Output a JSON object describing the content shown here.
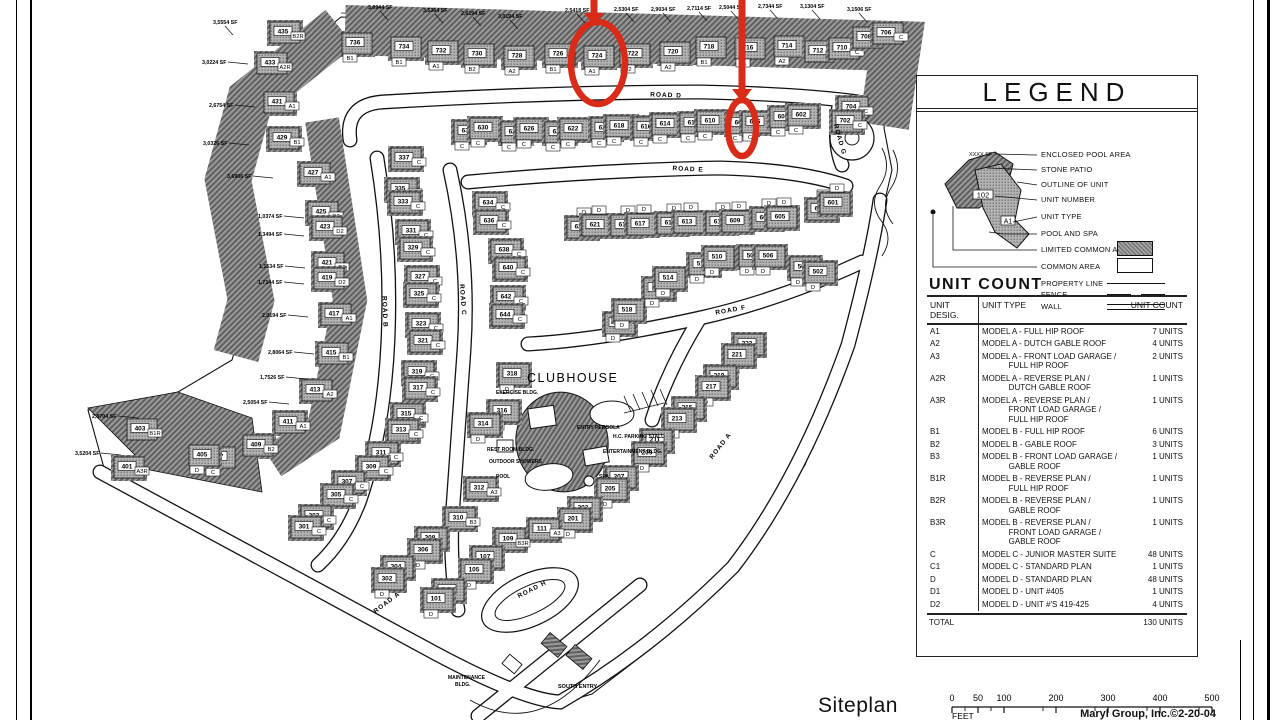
{
  "page": {
    "title_text": "Siteplan",
    "credit": "Maryl Group, Inc.©2-20-04",
    "feet_label": "FEET"
  },
  "legend": {
    "title": "LEGEND",
    "sample": {
      "sf": "XXXX SF",
      "number": "102",
      "type": "A1"
    },
    "items": [
      {
        "label": "ENCLOSED POOL AREA"
      },
      {
        "label": "STONE PATIO"
      },
      {
        "label": "OUTLINE OF UNIT"
      },
      {
        "label": "UNIT NUMBER"
      },
      {
        "label": "UNIT TYPE"
      },
      {
        "label": "POOL AND SPA"
      },
      {
        "label": "LIMITED COMMON AREA",
        "swatch": "hatched"
      },
      {
        "label": "COMMON AREA",
        "swatch": "open"
      },
      {
        "label": "PROPERTY LINE",
        "swatch": "line-solid"
      },
      {
        "label": "FENCE",
        "swatch": "line-dash"
      },
      {
        "label": "WALL",
        "swatch": "line-double"
      }
    ]
  },
  "unit_count": {
    "title": "UNIT COUNT",
    "col_desig_line1": "UNIT",
    "col_desig_line2": "DESIG.",
    "col_type": "UNIT TYPE",
    "col_count": "UNIT COUNT",
    "rows": [
      {
        "desig": "A1",
        "type": [
          "MODEL A - FULL HIP ROOF"
        ],
        "count": "7 UNITS"
      },
      {
        "desig": "A2",
        "type": [
          "MODEL A - DUTCH GABLE ROOF"
        ],
        "count": "4 UNITS"
      },
      {
        "desig": "A3",
        "type": [
          "MODEL A - FRONT LOAD GARAGE /",
          "FULL HIP ROOF"
        ],
        "count": "2 UNITS"
      },
      {
        "desig": "A2R",
        "type": [
          "MODEL A - REVERSE PLAN /",
          "DUTCH GABLE ROOF"
        ],
        "count": "1 UNITS"
      },
      {
        "desig": "A3R",
        "type": [
          "MODEL A - REVERSE PLAN /",
          "FRONT LOAD GARAGE /",
          "FULL HIP ROOF"
        ],
        "count": "1 UNITS"
      },
      {
        "desig": "B1",
        "type": [
          "MODEL B - FULL HIP ROOF"
        ],
        "count": "6 UNITS"
      },
      {
        "desig": "B2",
        "type": [
          "MODEL B - GABLE ROOF"
        ],
        "count": "3 UNITS"
      },
      {
        "desig": "B3",
        "type": [
          "MODEL B - FRONT LOAD GARAGE /",
          "GABLE ROOF"
        ],
        "count": "1 UNITS"
      },
      {
        "desig": "B1R",
        "type": [
          "MODEL B - REVERSE PLAN /",
          "FULL HIP ROOF"
        ],
        "count": "1 UNITS"
      },
      {
        "desig": "B2R",
        "type": [
          "MODEL B - REVERSE PLAN /",
          "GABLE ROOF"
        ],
        "count": "1 UNITS"
      },
      {
        "desig": "B3R",
        "type": [
          "MODEL B - REVERSE PLAN /",
          "FRONT LOAD GARAGE /",
          "GABLE ROOF"
        ],
        "count": "1 UNITS"
      },
      {
        "desig": "C",
        "type": [
          "MODEL C - JUNIOR MASTER SUITE"
        ],
        "count": "48 UNITS"
      },
      {
        "desig": "C1",
        "type": [
          "MODEL C - STANDARD PLAN"
        ],
        "count": "1 UNITS"
      },
      {
        "desig": "D",
        "type": [
          "MODEL D - STANDARD PLAN"
        ],
        "count": "48 UNITS"
      },
      {
        "desig": "D1",
        "type": [
          "MODEL D - UNIT #405"
        ],
        "count": "1 UNITS"
      },
      {
        "desig": "D2",
        "type": [
          "MODEL D - UNIT #'S 419-425"
        ],
        "count": "4 UNITS"
      }
    ],
    "total_label": "TOTAL",
    "total_count": "130 UNITS"
  },
  "scale_bar": {
    "ticks": [
      0,
      50,
      100,
      200,
      300,
      400,
      500
    ]
  },
  "map": {
    "road_labels": [
      {
        "t": "ROAD A",
        "x": 722,
        "y": 447,
        "r": -52
      },
      {
        "t": "ROAD A",
        "x": 388,
        "y": 604,
        "r": -37
      },
      {
        "t": "ROAD B",
        "x": 383,
        "y": 312,
        "r": 88
      },
      {
        "t": "ROAD C",
        "x": 461,
        "y": 300,
        "r": 86
      },
      {
        "t": "ROAD D",
        "x": 666,
        "y": 97,
        "r": 2
      },
      {
        "t": "ROAD E",
        "x": 688,
        "y": 171,
        "r": 3
      },
      {
        "t": "ROAD F",
        "x": 731,
        "y": 312,
        "r": -10
      },
      {
        "t": "ROAD G",
        "x": 838,
        "y": 140,
        "r": 74
      },
      {
        "t": "ROAD H",
        "x": 533,
        "y": 591,
        "r": -27
      }
    ],
    "site_labels": [
      {
        "t": "CLUBHOUSE",
        "x": 527,
        "y": 382,
        "s": 12.5
      },
      {
        "t": "EXERCISE BLDG.",
        "x": 496,
        "y": 394,
        "s": 5
      },
      {
        "t": "ENTRY PERGOLA",
        "x": 577,
        "y": 429,
        "s": 5
      },
      {
        "t": "H.C. PARKING STALL",
        "x": 613,
        "y": 438,
        "s": 5
      },
      {
        "t": "ENTERTAINMENT BLDG.",
        "x": 603,
        "y": 453,
        "s": 5
      },
      {
        "t": "REST ROOM BLDG.",
        "x": 487,
        "y": 451,
        "s": 5
      },
      {
        "t": "OUTDOOR SHOWERS",
        "x": 489,
        "y": 463,
        "s": 5
      },
      {
        "t": "POOL",
        "x": 496,
        "y": 478,
        "s": 5
      },
      {
        "t": "SPA",
        "x": 599,
        "y": 478,
        "s": 5
      },
      {
        "t": "MAINTENANCE",
        "x": 448,
        "y": 679,
        "s": 5
      },
      {
        "t": "BLDG.",
        "x": 455,
        "y": 686,
        "s": 5
      },
      {
        "t": "SOUTH ENTRY",
        "x": 558,
        "y": 688,
        "s": 5.5
      }
    ],
    "sf_labels": [
      {
        "t": "3,5554 SF",
        "x": 213,
        "y": 19
      },
      {
        "t": "3,0224 SF",
        "x": 202,
        "y": 59
      },
      {
        "t": "2,6754 SF",
        "x": 209,
        "y": 102
      },
      {
        "t": "3,0326 SF",
        "x": 203,
        "y": 140
      },
      {
        "t": "3,6906 SF",
        "x": 227,
        "y": 173
      },
      {
        "t": "1,0374 SF",
        "x": 258,
        "y": 213
      },
      {
        "t": "1,3494 SF",
        "x": 258,
        "y": 231
      },
      {
        "t": "1,1534 SF",
        "x": 259,
        "y": 263
      },
      {
        "t": "1,7144 SF",
        "x": 258,
        "y": 279
      },
      {
        "t": "2,0194 SF",
        "x": 262,
        "y": 312
      },
      {
        "t": "2,8064 SF",
        "x": 268,
        "y": 349
      },
      {
        "t": "1,7526 SF",
        "x": 260,
        "y": 374
      },
      {
        "t": "2,5054 SF",
        "x": 243,
        "y": 399
      },
      {
        "t": "2,8704 SF",
        "x": 92,
        "y": 413
      },
      {
        "t": "3,5204 SF",
        "x": 75,
        "y": 450
      },
      {
        "t": "3,0944 SF",
        "x": 368,
        "y": 4
      },
      {
        "t": "3,5364 SF",
        "x": 423,
        "y": 7
      },
      {
        "t": "2,6194 SF",
        "x": 461,
        "y": 10
      },
      {
        "t": "3,0194 SF",
        "x": 498,
        "y": 13
      },
      {
        "t": "2,5418 SF",
        "x": 565,
        "y": 7
      },
      {
        "t": "2,5304 SF",
        "x": 614,
        "y": 6
      },
      {
        "t": "2,9034 SF",
        "x": 651,
        "y": 6
      },
      {
        "t": "2,7114 SF",
        "x": 687,
        "y": 5
      },
      {
        "t": "2,5044 SF",
        "x": 719,
        "y": 4
      },
      {
        "t": "2,7344 SF",
        "x": 758,
        "y": 3
      },
      {
        "t": "3,1304 SF",
        "x": 800,
        "y": 3
      },
      {
        "t": "3,1506 SF",
        "x": 847,
        "y": 6
      }
    ],
    "units": [
      [
        736,
        "B1",
        355,
        42,
        0
      ],
      [
        734,
        "B1",
        404,
        46,
        0
      ],
      [
        732,
        "A1",
        441,
        50,
        0
      ],
      [
        730,
        "B2",
        477,
        53,
        0
      ],
      [
        728,
        "A2",
        517,
        55,
        0
      ],
      [
        726,
        "B1",
        558,
        53,
        0
      ],
      [
        724,
        "A1",
        597,
        55,
        0
      ],
      [
        722,
        "B2",
        633,
        53,
        0
      ],
      [
        720,
        "A2",
        673,
        51,
        0
      ],
      [
        718,
        "B1",
        709,
        46,
        0
      ],
      [
        716,
        "A1",
        748,
        47,
        0
      ],
      [
        714,
        "A2",
        787,
        45,
        0
      ],
      [
        712,
        "C",
        818,
        50,
        2
      ],
      [
        710,
        "C",
        842,
        47,
        2
      ],
      [
        708,
        "C",
        866,
        36,
        2
      ],
      [
        706,
        "C",
        886,
        32,
        2
      ],
      [
        704,
        "C",
        851,
        106,
        2
      ],
      [
        702,
        "C",
        845,
        120,
        2
      ],
      [
        435,
        "B2R",
        283,
        31,
        2
      ],
      [
        433,
        "A2R",
        270,
        62,
        2
      ],
      [
        431,
        "A1",
        277,
        101,
        2
      ],
      [
        429,
        "B1",
        282,
        137,
        2
      ],
      [
        427,
        "A1",
        313,
        172,
        2
      ],
      [
        425,
        "D2",
        321,
        211,
        2
      ],
      [
        423,
        "D2",
        325,
        226,
        2
      ],
      [
        421,
        "D2",
        327,
        262,
        2
      ],
      [
        419,
        "D2",
        327,
        277,
        2
      ],
      [
        417,
        "A1",
        334,
        313,
        2
      ],
      [
        415,
        "B1",
        331,
        352,
        2
      ],
      [
        413,
        "A2",
        315,
        389,
        2
      ],
      [
        411,
        "A1",
        288,
        421,
        2
      ],
      [
        409,
        "B2",
        256,
        444,
        2
      ],
      [
        407,
        "C",
        218,
        456,
        0
      ],
      [
        405,
        "D",
        202,
        454,
        0
      ],
      [
        403,
        "B1R",
        140,
        428,
        2
      ],
      [
        401,
        "A3R",
        127,
        466,
        2
      ],
      [
        337,
        "C",
        404,
        157,
        2
      ],
      [
        335,
        "C",
        400,
        188,
        2
      ],
      [
        333,
        "C",
        403,
        201,
        2
      ],
      [
        331,
        "C",
        411,
        230,
        2
      ],
      [
        329,
        "C",
        413,
        247,
        2
      ],
      [
        327,
        "C",
        420,
        276,
        2
      ],
      [
        325,
        "C",
        419,
        293,
        2
      ],
      [
        323,
        "C",
        421,
        323,
        2
      ],
      [
        321,
        "C",
        423,
        340,
        2
      ],
      [
        319,
        "C",
        417,
        371,
        2
      ],
      [
        317,
        "C",
        418,
        387,
        2
      ],
      [
        315,
        "C",
        406,
        413,
        2
      ],
      [
        313,
        "C",
        401,
        429,
        2
      ],
      [
        311,
        "C",
        381,
        452,
        2
      ],
      [
        309,
        "C",
        371,
        466,
        2
      ],
      [
        307,
        "C",
        347,
        481,
        2
      ],
      [
        305,
        "C",
        336,
        494,
        2
      ],
      [
        303,
        "C",
        314,
        515,
        2
      ],
      [
        301,
        "C",
        304,
        526,
        2
      ],
      [
        634,
        "C",
        488,
        202,
        2
      ],
      [
        636,
        "C",
        489,
        220,
        2
      ],
      [
        638,
        "C",
        504,
        249,
        2
      ],
      [
        640,
        "C",
        508,
        267,
        2
      ],
      [
        642,
        "C",
        506,
        296,
        2
      ],
      [
        644,
        "C",
        505,
        314,
        2
      ],
      [
        632,
        "C",
        467,
        130,
        0
      ],
      [
        630,
        "C",
        483,
        127,
        0
      ],
      [
        628,
        "C",
        514,
        131,
        0
      ],
      [
        626,
        "C",
        529,
        128,
        0
      ],
      [
        624,
        "C",
        558,
        131,
        0
      ],
      [
        622,
        "C",
        573,
        128,
        0
      ],
      [
        620,
        "C",
        604,
        127,
        0
      ],
      [
        618,
        "C",
        619,
        125,
        0
      ],
      [
        616,
        "C",
        646,
        126,
        0
      ],
      [
        614,
        "C",
        665,
        123,
        0
      ],
      [
        612,
        "C",
        693,
        122,
        0
      ],
      [
        610,
        "C",
        710,
        120,
        0
      ],
      [
        608,
        "C",
        740,
        122,
        0
      ],
      [
        606,
        "C",
        755,
        121,
        0
      ],
      [
        604,
        "C",
        783,
        116,
        0
      ],
      [
        602,
        "C",
        801,
        114,
        0
      ],
      [
        623,
        "D",
        580,
        226,
        1
      ],
      [
        621,
        "D",
        595,
        224,
        1
      ],
      [
        619,
        "D",
        624,
        224,
        1
      ],
      [
        617,
        "D",
        640,
        223,
        1
      ],
      [
        615,
        "D",
        670,
        222,
        1
      ],
      [
        613,
        "D",
        687,
        221,
        1
      ],
      [
        611,
        "D",
        719,
        221,
        1
      ],
      [
        609,
        "D",
        735,
        220,
        1
      ],
      [
        607,
        "D",
        765,
        217,
        1
      ],
      [
        605,
        "D",
        780,
        216,
        1
      ],
      [
        603,
        "D",
        820,
        208,
        1
      ],
      [
        601,
        "D",
        833,
        202,
        1
      ],
      [
        520,
        "D",
        618,
        322,
        0
      ],
      [
        518,
        "D",
        627,
        309,
        0
      ],
      [
        516,
        "D",
        657,
        287,
        0
      ],
      [
        514,
        "D",
        668,
        277,
        0
      ],
      [
        512,
        "D",
        702,
        263,
        0
      ],
      [
        510,
        "D",
        717,
        256,
        0
      ],
      [
        508,
        "D",
        752,
        255,
        0
      ],
      [
        506,
        "D",
        768,
        255,
        0
      ],
      [
        504,
        "D",
        803,
        266,
        0
      ],
      [
        502,
        "D",
        818,
        271,
        0
      ],
      [
        223,
        "D",
        747,
        343,
        0
      ],
      [
        221,
        "D",
        737,
        354,
        0
      ],
      [
        219,
        "D",
        719,
        375,
        0
      ],
      [
        217,
        "D",
        711,
        386,
        0
      ],
      [
        215,
        "D",
        687,
        407,
        0
      ],
      [
        213,
        "D",
        677,
        418,
        0
      ],
      [
        211,
        "D",
        655,
        439,
        0
      ],
      [
        209,
        "D",
        647,
        452,
        0
      ],
      [
        207,
        "D",
        619,
        476,
        0
      ],
      [
        205,
        "D",
        610,
        488,
        0
      ],
      [
        203,
        "D",
        583,
        507,
        0
      ],
      [
        201,
        "D",
        573,
        518,
        0
      ],
      [
        111,
        "A3",
        542,
        528,
        2
      ],
      [
        109,
        "B3R",
        508,
        538,
        2
      ],
      [
        107,
        "D",
        485,
        556,
        0
      ],
      [
        105,
        "D",
        474,
        569,
        0
      ],
      [
        103,
        "D",
        447,
        589,
        0
      ],
      [
        101,
        "D",
        436,
        598,
        0
      ],
      [
        318,
        "D",
        512,
        373,
        0
      ],
      [
        316,
        "D",
        502,
        410,
        0
      ],
      [
        314,
        "D",
        483,
        423,
        0
      ],
      [
        312,
        "A3",
        479,
        487,
        2
      ],
      [
        310,
        "B3",
        458,
        517,
        2
      ],
      [
        308,
        "D",
        430,
        537,
        0
      ],
      [
        306,
        "D",
        423,
        549,
        0
      ],
      [
        304,
        "D",
        396,
        566,
        0
      ],
      [
        302,
        "D",
        387,
        578,
        0
      ]
    ],
    "annotations": {
      "color": "#d92b17",
      "circles": [
        {
          "cx": 598,
          "cy": 63,
          "rx": 27,
          "ry": 41
        },
        {
          "cx": 742,
          "cy": 128,
          "rx": 14,
          "ry": 28
        }
      ],
      "arrows": [
        {
          "x": 594,
          "y1": 0,
          "y2": 22
        },
        {
          "x": 742,
          "y1": 0,
          "y2": 98
        }
      ]
    }
  }
}
